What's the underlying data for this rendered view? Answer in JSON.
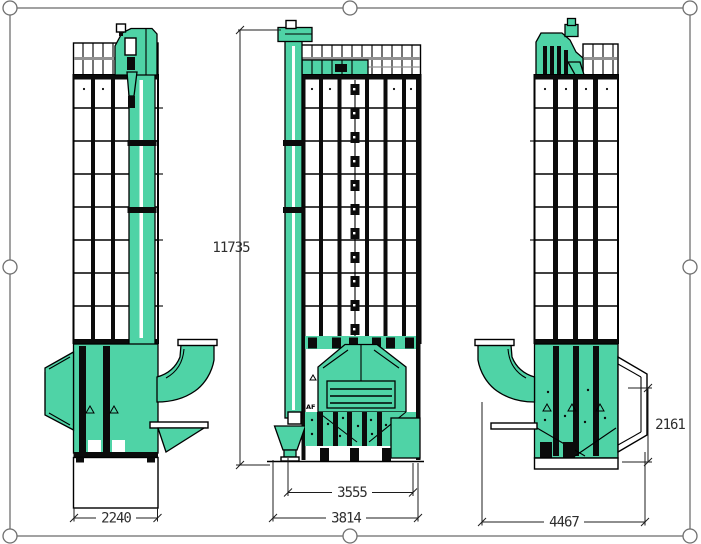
{
  "drawing": {
    "af_label": "AF",
    "views": [
      {
        "id": "left-side-view"
      },
      {
        "id": "front-view"
      },
      {
        "id": "right-side-view"
      }
    ]
  },
  "dims": {
    "left_view": {
      "base_width": "2240"
    },
    "front_view": {
      "overall_height": "11735",
      "inner_width": "3555",
      "base_width": "3814"
    },
    "right_view": {
      "overall_width": "4467",
      "lower_section_height": "2161"
    }
  },
  "colors": {
    "machine_teal": "#4fd3a6",
    "grid_gray": "#929292",
    "frame_gray": "#6f6f6f",
    "dim_line": "#1c1c1c",
    "dim_text": "#2e2e2e"
  }
}
